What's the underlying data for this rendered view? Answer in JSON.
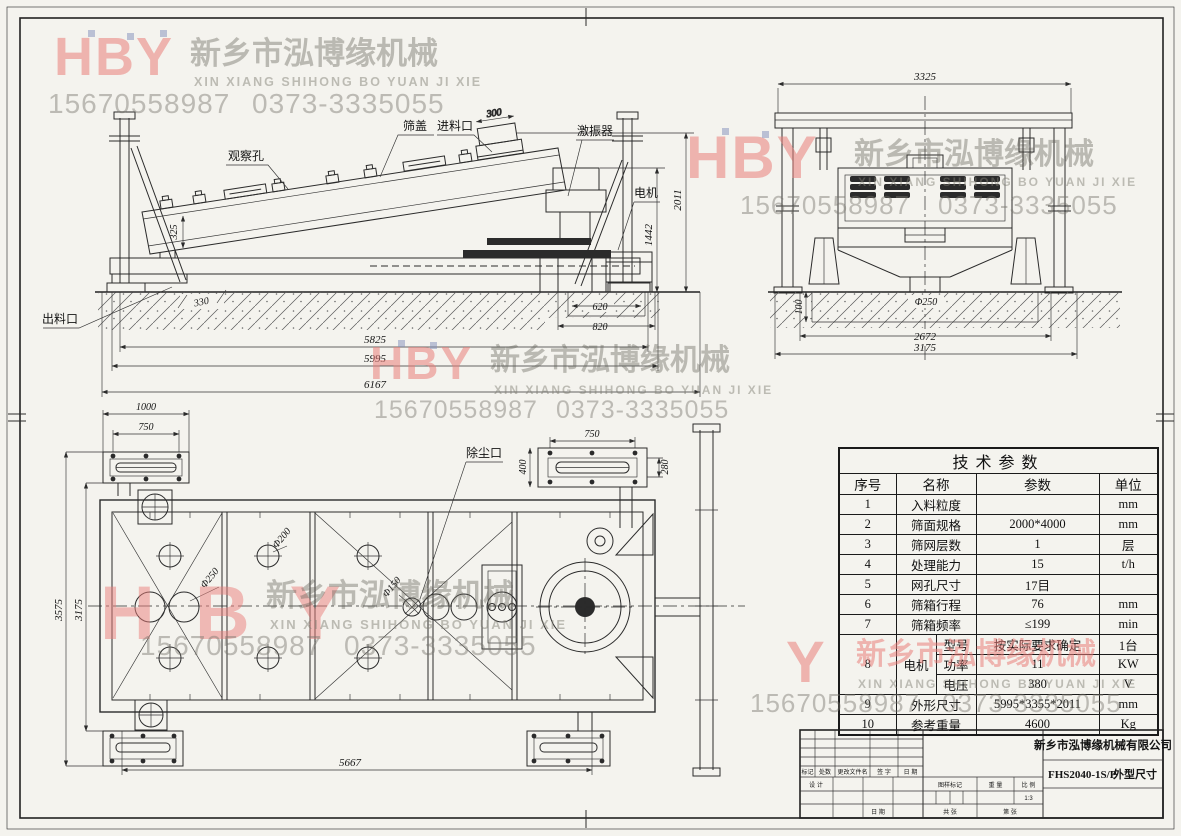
{
  "watermark": {
    "logo": "HBY",
    "logo_partial": "Y",
    "company_cn": "新乡市泓博缘机械",
    "company_en": "XIN XIANG SHIHONG BO YUAN JI XIE",
    "phone_mobile": "15670558987",
    "phone_tel": "0373-3335055",
    "colors": {
      "pink": "#e97d7a",
      "gray": "#8a887f",
      "blue": "#808eba"
    }
  },
  "side_view": {
    "labels": {
      "observation_hole": "观察孔",
      "screen_cover": "筛盖",
      "feed_inlet": "进料口",
      "exciter": "激振器",
      "motor": "电机",
      "discharge_outlet": "出料口"
    },
    "dims": {
      "inlet_width": "300",
      "total_height": "2011",
      "motor_height": "1442",
      "box_depth": "325",
      "foot_inset": "330",
      "pit_inner": "620",
      "pit_outer": "820",
      "length_base": "5825",
      "length_frame": "5995",
      "length_total": "6167"
    }
  },
  "end_view": {
    "dims": {
      "width_top": "3325",
      "pit_depth": "100",
      "outlet_dia": "Φ250",
      "span_inner": "2672",
      "span_outer": "3175"
    }
  },
  "top_view": {
    "labels": {
      "dust_port": "除尘口"
    },
    "dims": {
      "flange_length": "1000",
      "flange_bolt_span": "750",
      "dust_bolt_span": "750",
      "dust_flange_width": "400",
      "dust_inner_width": "280",
      "width_outer": "3575",
      "width_inner": "3175",
      "base_span": "5667",
      "hole_large": "Φ250",
      "hole_mid": "Φ200",
      "hole_small": "Φ150"
    }
  },
  "spec_table": {
    "title": "技术参数",
    "headers": {
      "no": "序号",
      "name": "名称",
      "value": "参数",
      "unit": "单位"
    },
    "rows": [
      {
        "no": "1",
        "name": "入料粒度",
        "value": "",
        "unit": "mm"
      },
      {
        "no": "2",
        "name": "筛面规格",
        "value": "2000*4000",
        "unit": "mm"
      },
      {
        "no": "3",
        "name": "筛网层数",
        "value": "1",
        "unit": "层"
      },
      {
        "no": "4",
        "name": "处理能力",
        "value": "15",
        "unit": "t/h"
      },
      {
        "no": "5",
        "name": "网孔尺寸",
        "value": "17目",
        "unit": ""
      },
      {
        "no": "6",
        "name": "筛箱行程",
        "value": "76",
        "unit": "mm"
      },
      {
        "no": "7",
        "name": "筛箱频率",
        "value": "≤199",
        "unit": "min"
      }
    ],
    "motor": {
      "no": "8",
      "name": "电机",
      "sub_rows": [
        {
          "label": "型号",
          "value": "按实际要求确定",
          "unit": "1台"
        },
        {
          "label": "功率",
          "value": "11",
          "unit": "KW"
        },
        {
          "label": "电压",
          "value": "380",
          "unit": "V"
        }
      ]
    },
    "tail_rows": [
      {
        "no": "9",
        "name": "外形尺寸",
        "value": "5995*3355*2011",
        "unit": "mm"
      },
      {
        "no": "10",
        "name": "参考重量",
        "value": "4600",
        "unit": "Kg"
      }
    ]
  },
  "title_block": {
    "company": "新乡市泓博缘机械有限公司",
    "drawing_no": "FHS2040-1S/P",
    "drawing_title": "外型尺寸",
    "scale_value": "1:3",
    "labels": {
      "mark": "标记",
      "count": "处数",
      "change_file": "更改文件名",
      "signature": "签 字",
      "date": "日 期",
      "design": "设 计",
      "drawing_mark": "图样标记",
      "weight": "重 量",
      "scale": "比 例",
      "sheets_total": "共  张",
      "sheet_no": "第  张",
      "date2": "日 期"
    }
  }
}
